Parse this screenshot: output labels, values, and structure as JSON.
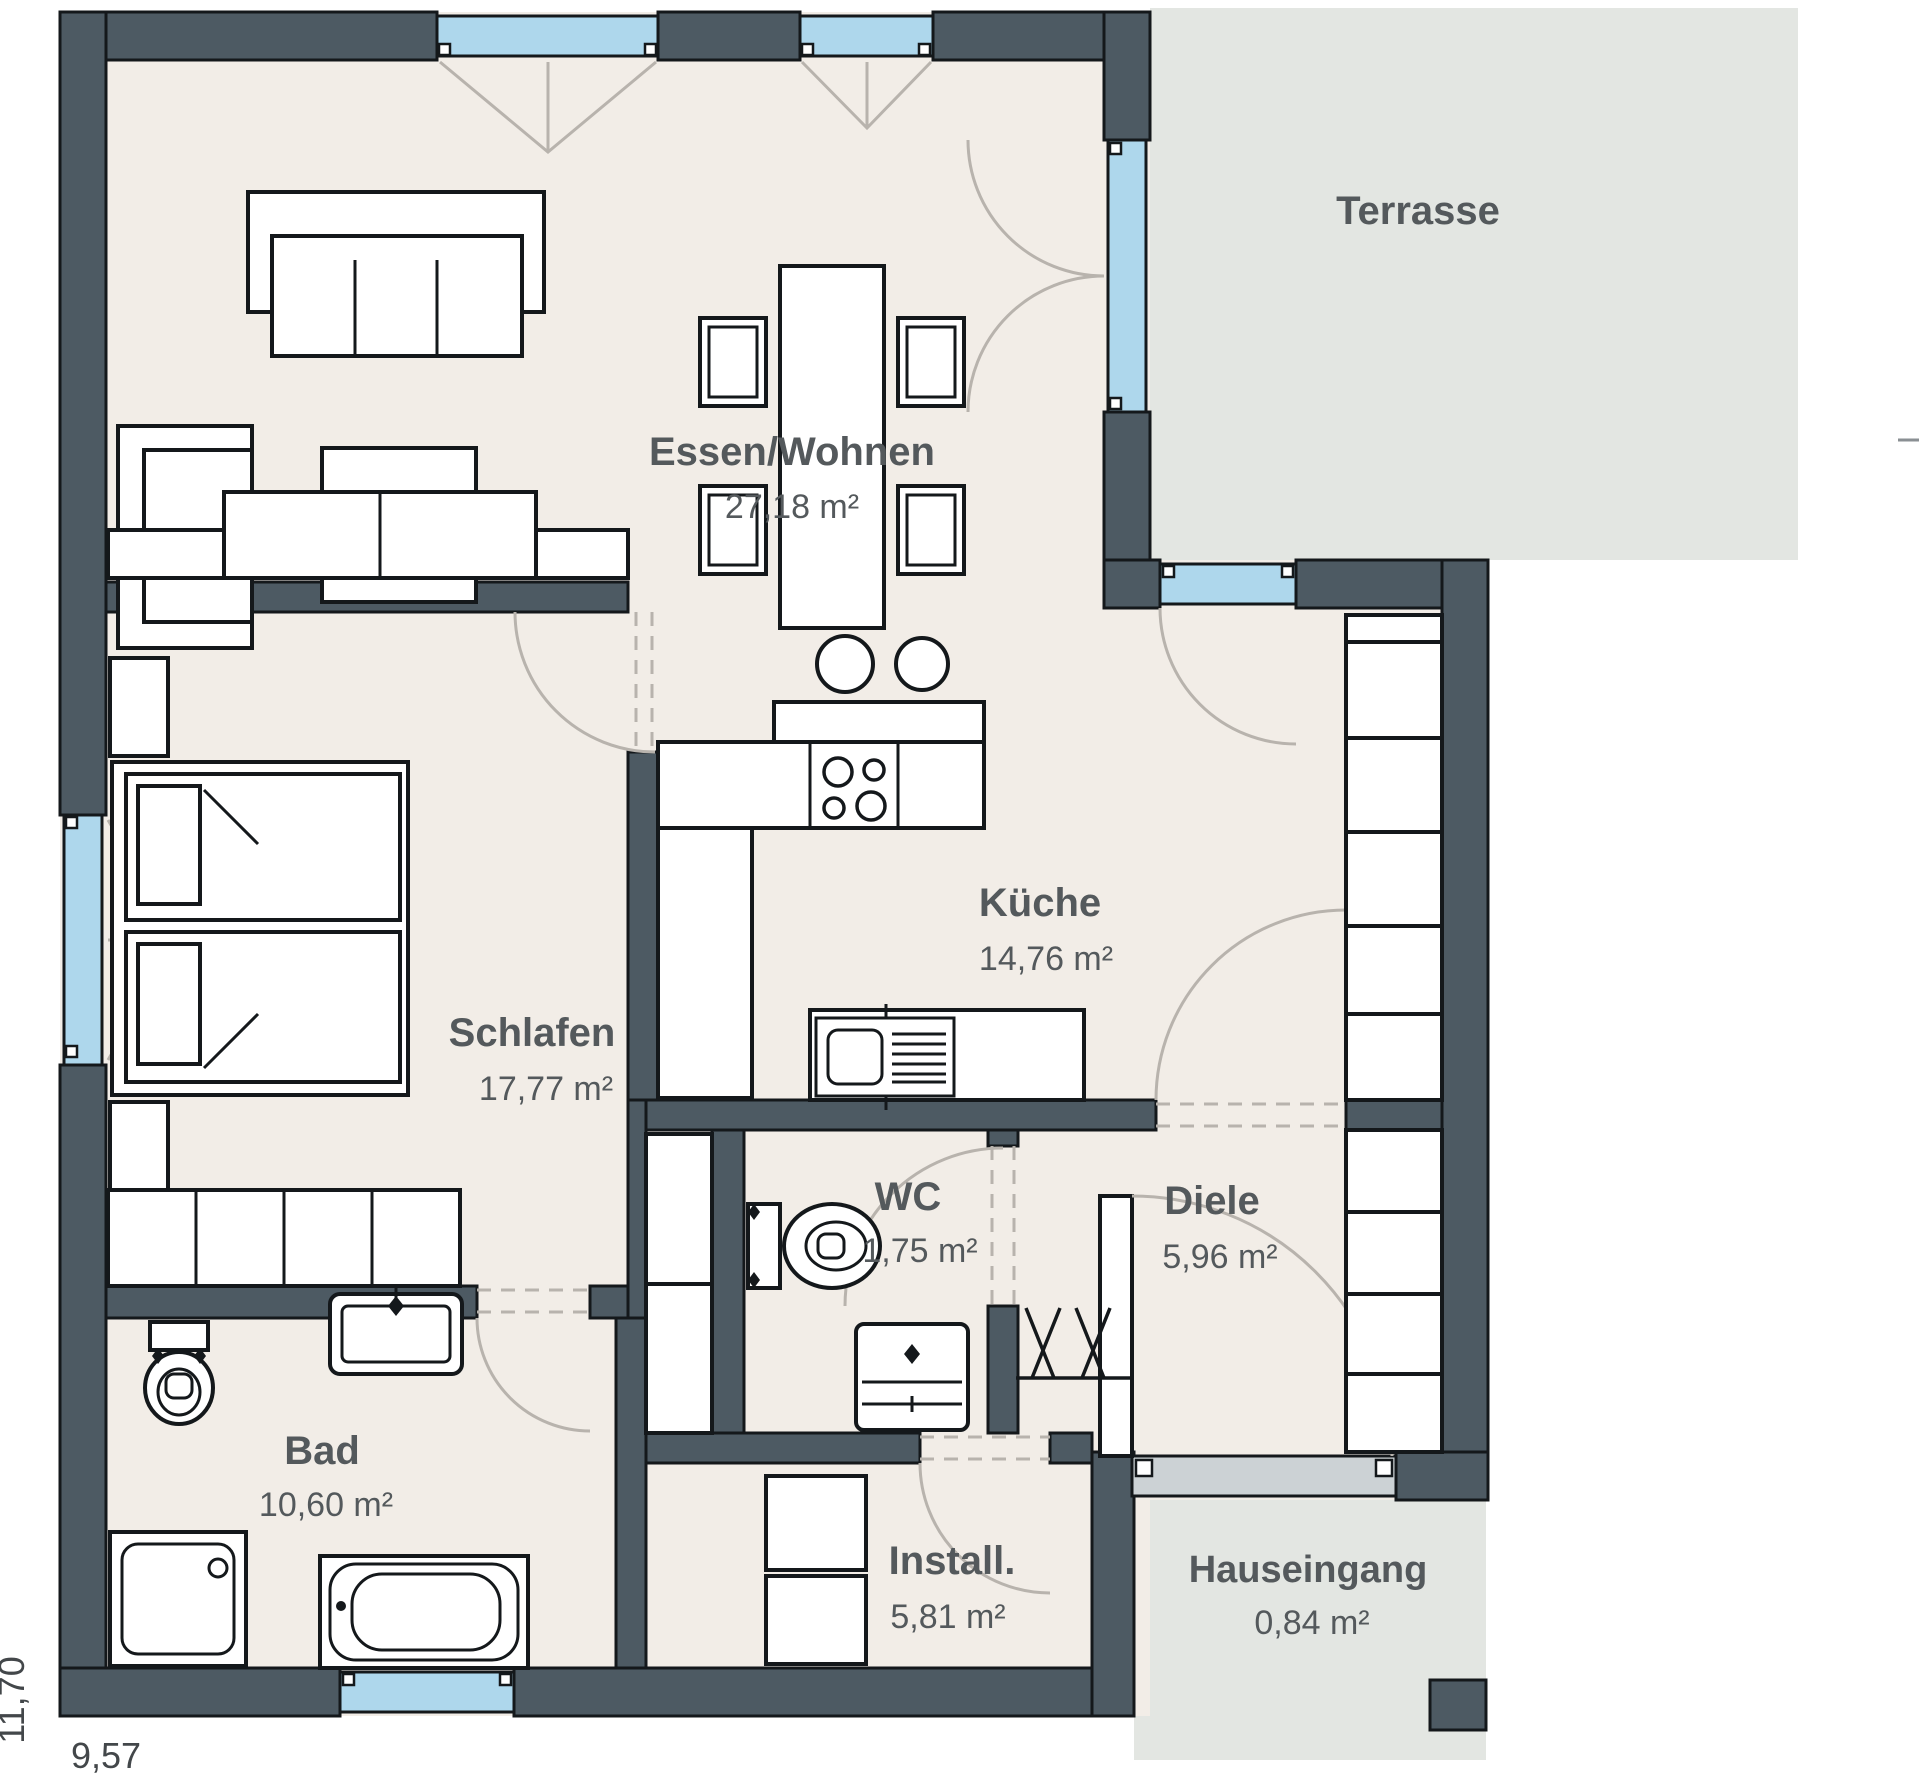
{
  "page": {
    "type": "architectural-floor-plan",
    "language": "de"
  },
  "colors": {
    "wall": "#4d5a63",
    "floor": "#f2ede7",
    "outdoor": "#e3e6e2",
    "window_glass": "#aed7ec",
    "door_arc": "#b8b3ad",
    "threshold": "#ccd2d5",
    "label_text": "#54595c"
  },
  "rooms": [
    {
      "id": "essen-wohnen",
      "name": "Essen/Wohnen",
      "area": "27,18 m²"
    },
    {
      "id": "terrasse",
      "name": "Terrasse",
      "area": ""
    },
    {
      "id": "kueche",
      "name": "Küche",
      "area": "14,76 m²"
    },
    {
      "id": "schlafen",
      "name": "Schlafen",
      "area": "17,77 m²"
    },
    {
      "id": "wc",
      "name": "WC",
      "area": "1,75 m²"
    },
    {
      "id": "diele",
      "name": "Diele",
      "area": "5,96 m²"
    },
    {
      "id": "bad",
      "name": "Bad",
      "area": "10,60 m²"
    },
    {
      "id": "install",
      "name": "Install.",
      "area": "5,81 m²"
    },
    {
      "id": "hauseingang",
      "name": "Hauseingang",
      "area": "0,84 m²"
    }
  ],
  "dimensions": {
    "total_width_m": "9,57",
    "total_height_m": "11,70"
  }
}
